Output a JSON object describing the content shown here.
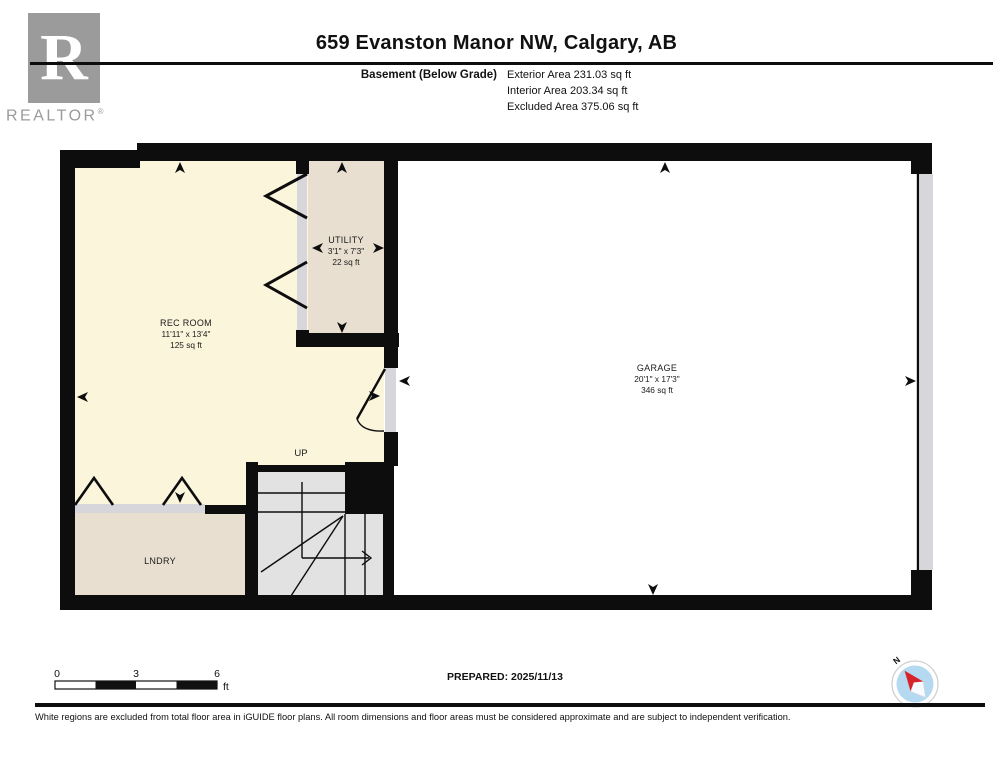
{
  "header": {
    "title": "659 Evanston Manor NW, Calgary, AB",
    "floor_label": "Basement (Below Grade)",
    "areas": [
      {
        "label": "Exterior Area 231.03 sq ft"
      },
      {
        "label": "Interior Area 203.34 sq ft"
      },
      {
        "label": "Excluded Area 375.06 sq ft"
      }
    ]
  },
  "logo": {
    "letter": "R",
    "brand": "REALTOR",
    "registered": "®"
  },
  "plan": {
    "rooms": [
      {
        "name": "REC ROOM",
        "dims": "11'11\" x 13'4\"",
        "area": "125 sq ft"
      },
      {
        "name": "UTILITY",
        "dims": "3'1\" x 7'3\"",
        "area": "22 sq ft"
      },
      {
        "name": "GARAGE",
        "dims": "20'1\" x 17'3\"",
        "area": "346 sq ft"
      },
      {
        "name": "LNDRY"
      }
    ],
    "stairs_label": "UP",
    "compass_north": "N"
  },
  "scale_bar": {
    "start": "0",
    "mid": "3",
    "end": "6",
    "unit": "ft"
  },
  "footer": {
    "prepared": "PREPARED: 2025/11/13",
    "disclaimer": "White regions are excluded from total floor area in iGUIDE floor plans. All room dimensions and floor areas must be considered approximate and are subject to independent verification."
  },
  "colors": {
    "room_cream": "#FBF5DC",
    "room_tan": "#E9DFD0",
    "stairs_gray": "#E2E2E2",
    "door_gray": "#D7D7DB",
    "wall_black": "#0D0D0D",
    "garage_white": "#FFFFFF",
    "compass_blue": "#B5D9F0",
    "compass_red": "#D8232A"
  }
}
